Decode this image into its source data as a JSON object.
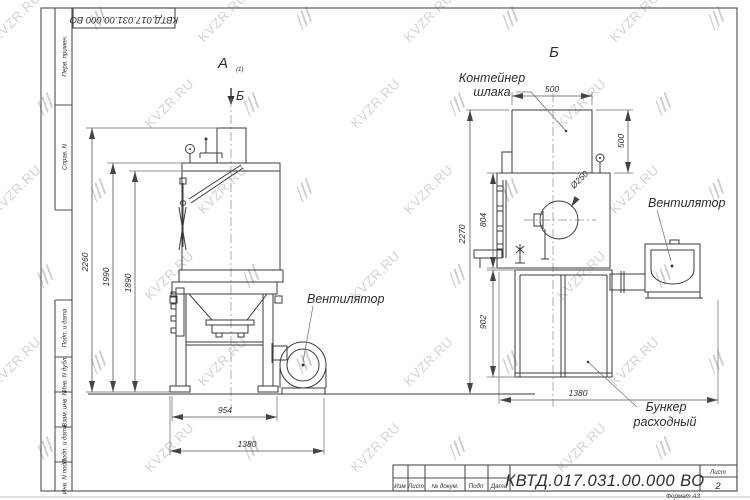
{
  "watermark": {
    "text": "KVZR.RU"
  },
  "frame": {
    "doc_number_top": "КВТД.017.031.00.000  ВО",
    "left_labels": [
      "Перв. примен.",
      "Справ. N",
      "Подп. и дата",
      "Инв. N дубл.",
      "Взам. инв. N",
      "Подп. и дата",
      "Инв. N подл."
    ]
  },
  "title_block": {
    "doc_number": "КВТД.017.031.00.000  ВО",
    "columns": [
      "Изм",
      "Лист",
      "№ докум.",
      "Подп",
      "Дата"
    ],
    "sheet_label": "Лист",
    "sheet_number": "2",
    "format_label": "Формат А3"
  },
  "views": {
    "left": {
      "label": "А",
      "label_scale": "(1)",
      "section_marker": "Б",
      "fan_callout": "Вентилятор",
      "dims": {
        "total_height": "2260",
        "body_height": "1990",
        "inner_height": "1890",
        "frame_width": "954",
        "overall_width": "1380"
      }
    },
    "right": {
      "label": "Б",
      "slag_container_line1": "Контейнер",
      "slag_container_line2": "шлака",
      "fan_callout": "Вентилятор",
      "hopper_line1": "Бункер",
      "hopper_line2": "расходный",
      "dims": {
        "container_width": "500",
        "container_height": "500",
        "body_height": "804",
        "total_height": "2270",
        "bunker_height": "902",
        "overall_width": "1380",
        "port_diameter": "Ø250"
      }
    }
  }
}
